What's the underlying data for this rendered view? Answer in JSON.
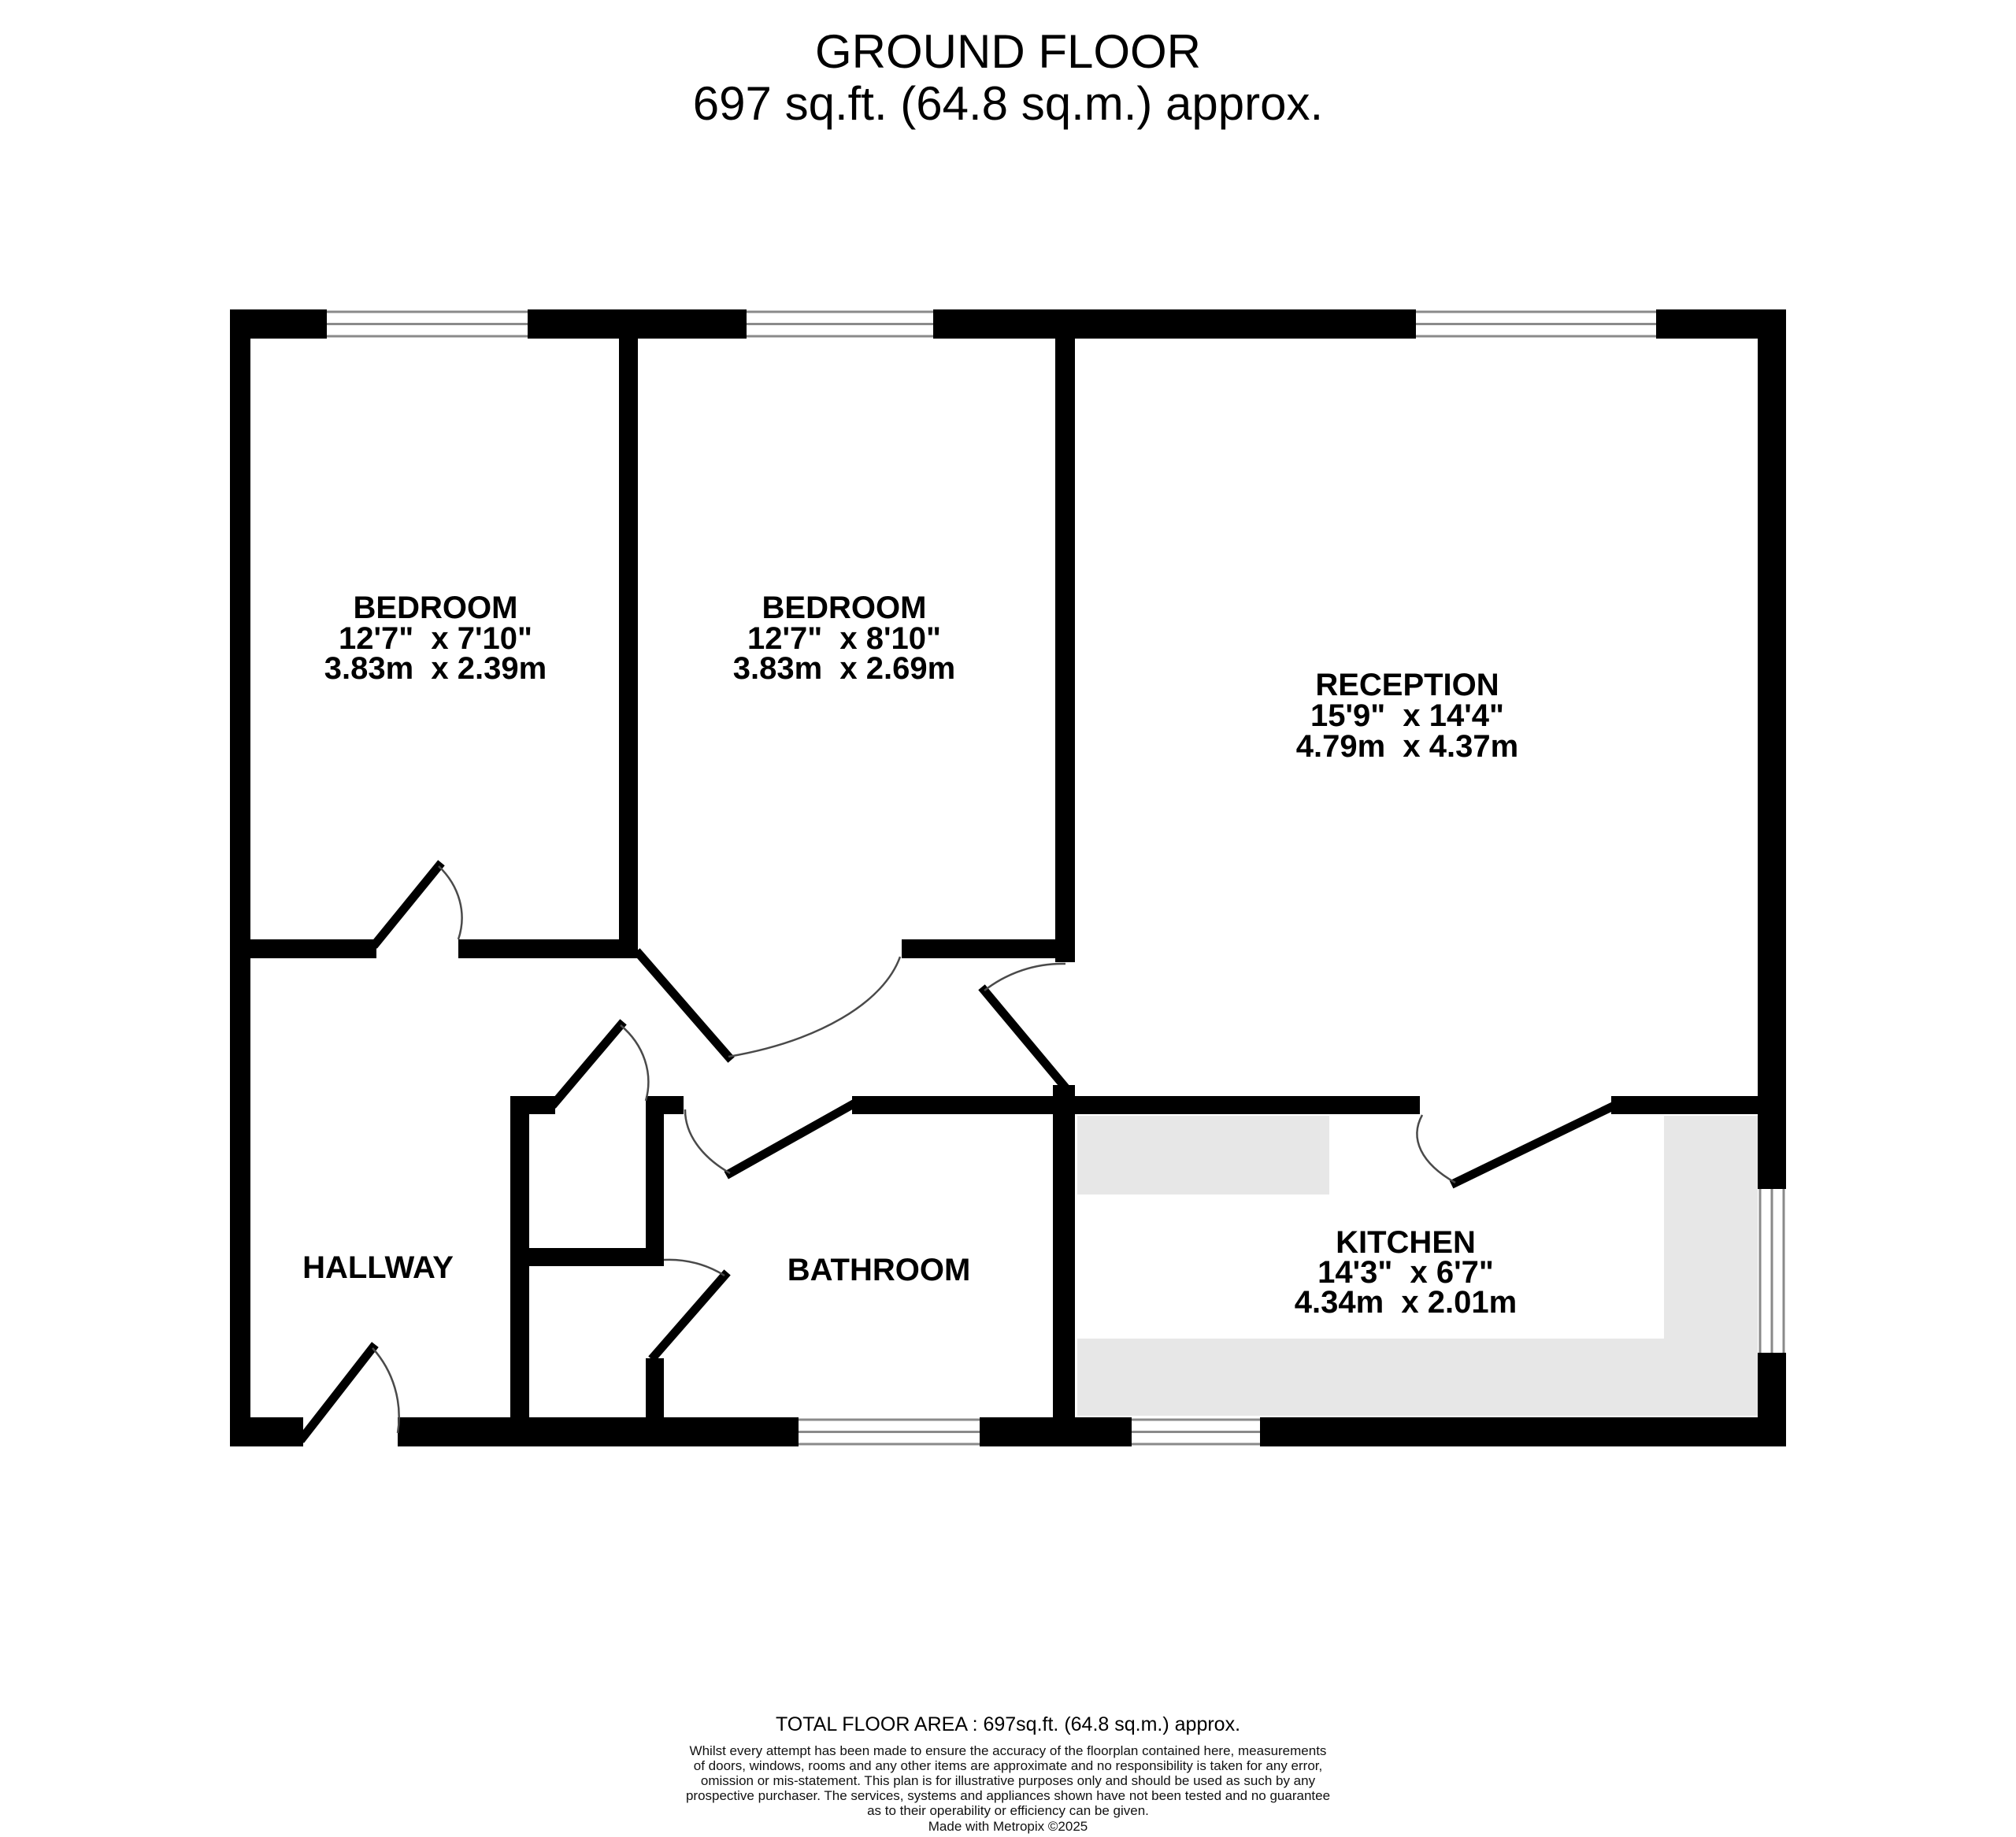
{
  "title": {
    "line1": "GROUND FLOOR",
    "line2": "697 sq.ft. (64.8 sq.m.) approx."
  },
  "rooms": {
    "bedroom1": {
      "name": "BEDROOM",
      "imperial": "12'7\"  x 7'10\"",
      "metric": "3.83m  x 2.39m"
    },
    "bedroom2": {
      "name": "BEDROOM",
      "imperial": "12'7\"  x 8'10\"",
      "metric": "3.83m  x 2.69m"
    },
    "reception": {
      "name": "RECEPTION",
      "imperial": "15'9\"  x 14'4\"",
      "metric": "4.79m  x 4.37m"
    },
    "kitchen": {
      "name": "KITCHEN",
      "imperial": "14'3\"  x 6'7\"",
      "metric": "4.34m  x 2.01m"
    },
    "hallway": {
      "name": "HALLWAY"
    },
    "bathroom": {
      "name": "BATHROOM"
    }
  },
  "footer": {
    "total_area": "TOTAL FLOOR AREA : 697sq.ft. (64.8 sq.m.) approx.",
    "disclaimer_lines": [
      "Whilst every attempt has been made to ensure the accuracy of the floorplan contained here, measurements",
      "of doors, windows, rooms and any other items are approximate and no responsibility is taken for any error,",
      "omission or mis-statement. This plan is for illustrative purposes only and should be used as such by any",
      "prospective purchaser. The services, systems and appliances shown have not been tested and no guarantee",
      "as to their operability or efficiency can be given."
    ],
    "credit": "Made with Metropix ©2025"
  },
  "colors": {
    "wall": "#000000",
    "counter": "#e7e7e7",
    "windowFrame": "#8a8a8a",
    "doorArc": "#4a4a4a"
  }
}
